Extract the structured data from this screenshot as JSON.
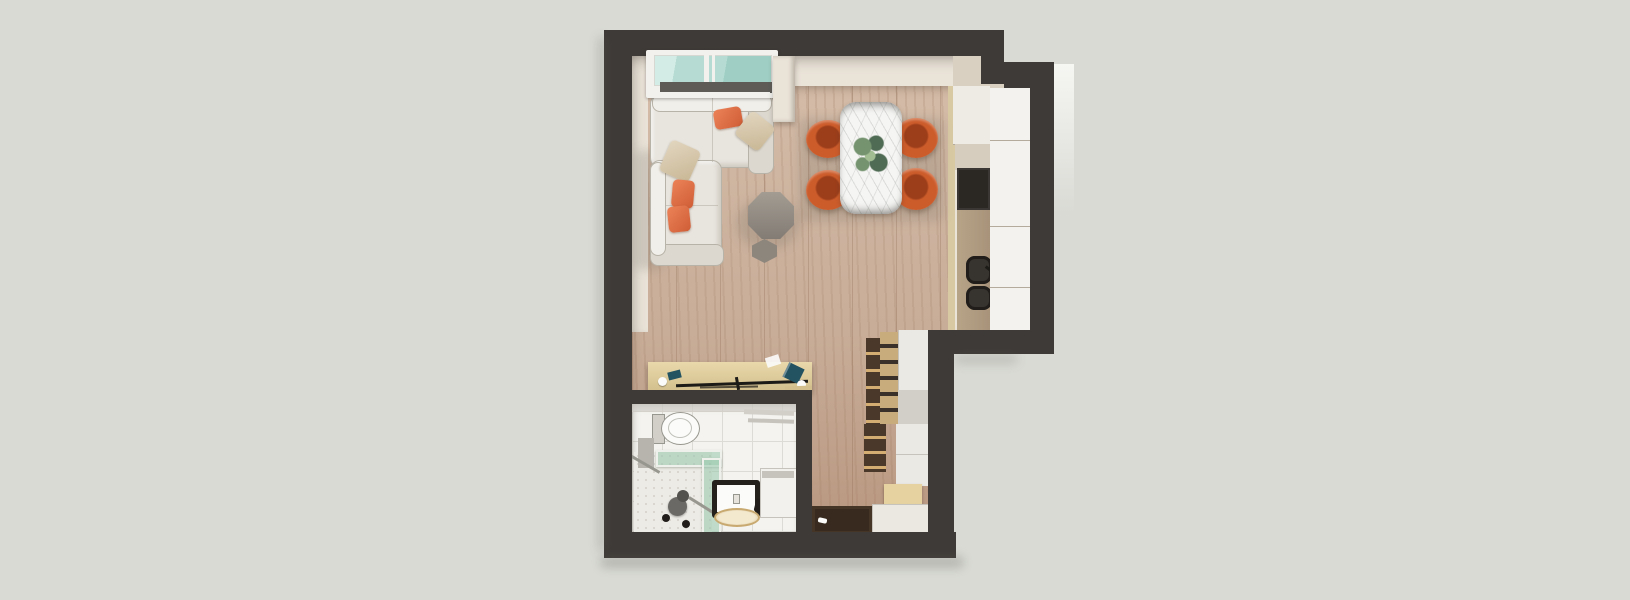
{
  "scene": {
    "type": "floor-plan-3d-render",
    "view": "top-down",
    "rooms": [
      "living-room",
      "dining-area",
      "kitchen",
      "hallway",
      "bathroom",
      "entry"
    ],
    "objects": [
      "window",
      "corner-sofa",
      "throw-pillows",
      "coffee-table",
      "side-table",
      "dining-table",
      "dining-chairs",
      "plant-centerpiece",
      "kitchen-counter",
      "oven",
      "cooktop-sink",
      "console-table",
      "desk-items",
      "wardrobe",
      "shoe-bench",
      "entry-mat",
      "toilet",
      "wall-shelf",
      "shower-enclosure",
      "shower-chair",
      "grab-bars",
      "vanity-basin",
      "washing-machine"
    ]
  },
  "palette": {
    "bg": "#d9dad4",
    "wall": "#3e3a37",
    "cream": "#eae3d8",
    "creamShade": "#d9d0c2",
    "floorBase": "#c8ad98",
    "floorGrain": "#b99780",
    "floorJoint": "#a98970",
    "floorLight": "#d3bba7",
    "sofaBody": "#e8e5de",
    "sofaShade": "#dcd8cf",
    "sofaHighlight": "#f1efe9",
    "sofaLine": "#b8b3a8",
    "pillowOrangeA": "#ec8257",
    "pillowOrangeB": "#cf5d36",
    "pillowBeigeA": "#e2d6c0",
    "pillowBeigeB": "#c9b795",
    "octTableA": "#a39c93",
    "octTableB": "#837c74",
    "hexTable": "#8d867d",
    "marble": "#f5f5f3",
    "tableEdge": "#55524e",
    "chairOrange": "#cd5c2b",
    "chairDeep": "#9c3e1a",
    "chairRim": "#e17c47",
    "chairShadow": "rgba(96,74,56,0.45)",
    "plantDark": "#4f6b53",
    "plantMid": "#75936f",
    "plantLight": "#a3bd93",
    "counterWhite": "#eeebe5",
    "counterFace": "#f3f2ee",
    "counterTaupe": "#d6cdbf",
    "counterTan": "#b7a487",
    "counterSeam": "#b4ab9c",
    "appliance": "#2b2723",
    "burner": "#37332e",
    "burnerDark": "#201d1a",
    "stripWood": "#d9c9a3",
    "consoleWoodA": "#e9d8ab",
    "consoleWoodB": "#d2bf8d",
    "itemTeal": "#235261",
    "rodDark": "#1d1b18",
    "windowFrame": "#f2f1ed",
    "windowGlassA": "#b5dbd2",
    "windowGlassB": "#d3ece6",
    "windowGlassC": "#9fcfc4",
    "sill": "#5e5b57",
    "tile": "#f4f3ef",
    "grout": "#dddbd5",
    "penny": "#edebe5",
    "pennyDot": "#d9d6d0",
    "glassGreen": "rgba(150,199,172,0.55)",
    "glassFrame": "#eef0ec",
    "fixtureOutline": "#98978f",
    "porcelain": "#fbfbf9",
    "grayPanel": "#b7b4ae",
    "chairGray": "#6b6966",
    "chairGrayDark": "#54524e",
    "vanityDark": "#24201b",
    "basinRim": "#c8a96f",
    "basinFill": "#f3e9cf",
    "washer": "#f2f1ed",
    "washerTrim": "#c6c3bc",
    "wardrobeWood": "#c9ac7c",
    "wardrobeSlot": "#3a322a",
    "woodSideDark": "#4a392b",
    "shelfLight": "#d3ad72",
    "cabWhite": "#ebe9e4",
    "cabGray": "#d2cfc9",
    "benchTan": "#e5d2a0",
    "benchFace": "#d4bf8a",
    "matBrown": "#382a1e",
    "matInner": "#453526",
    "entryTile": "#eae8e1",
    "extFace": "#f6f6f3",
    "shadowSoft": "rgba(95,92,85,0.4)"
  }
}
